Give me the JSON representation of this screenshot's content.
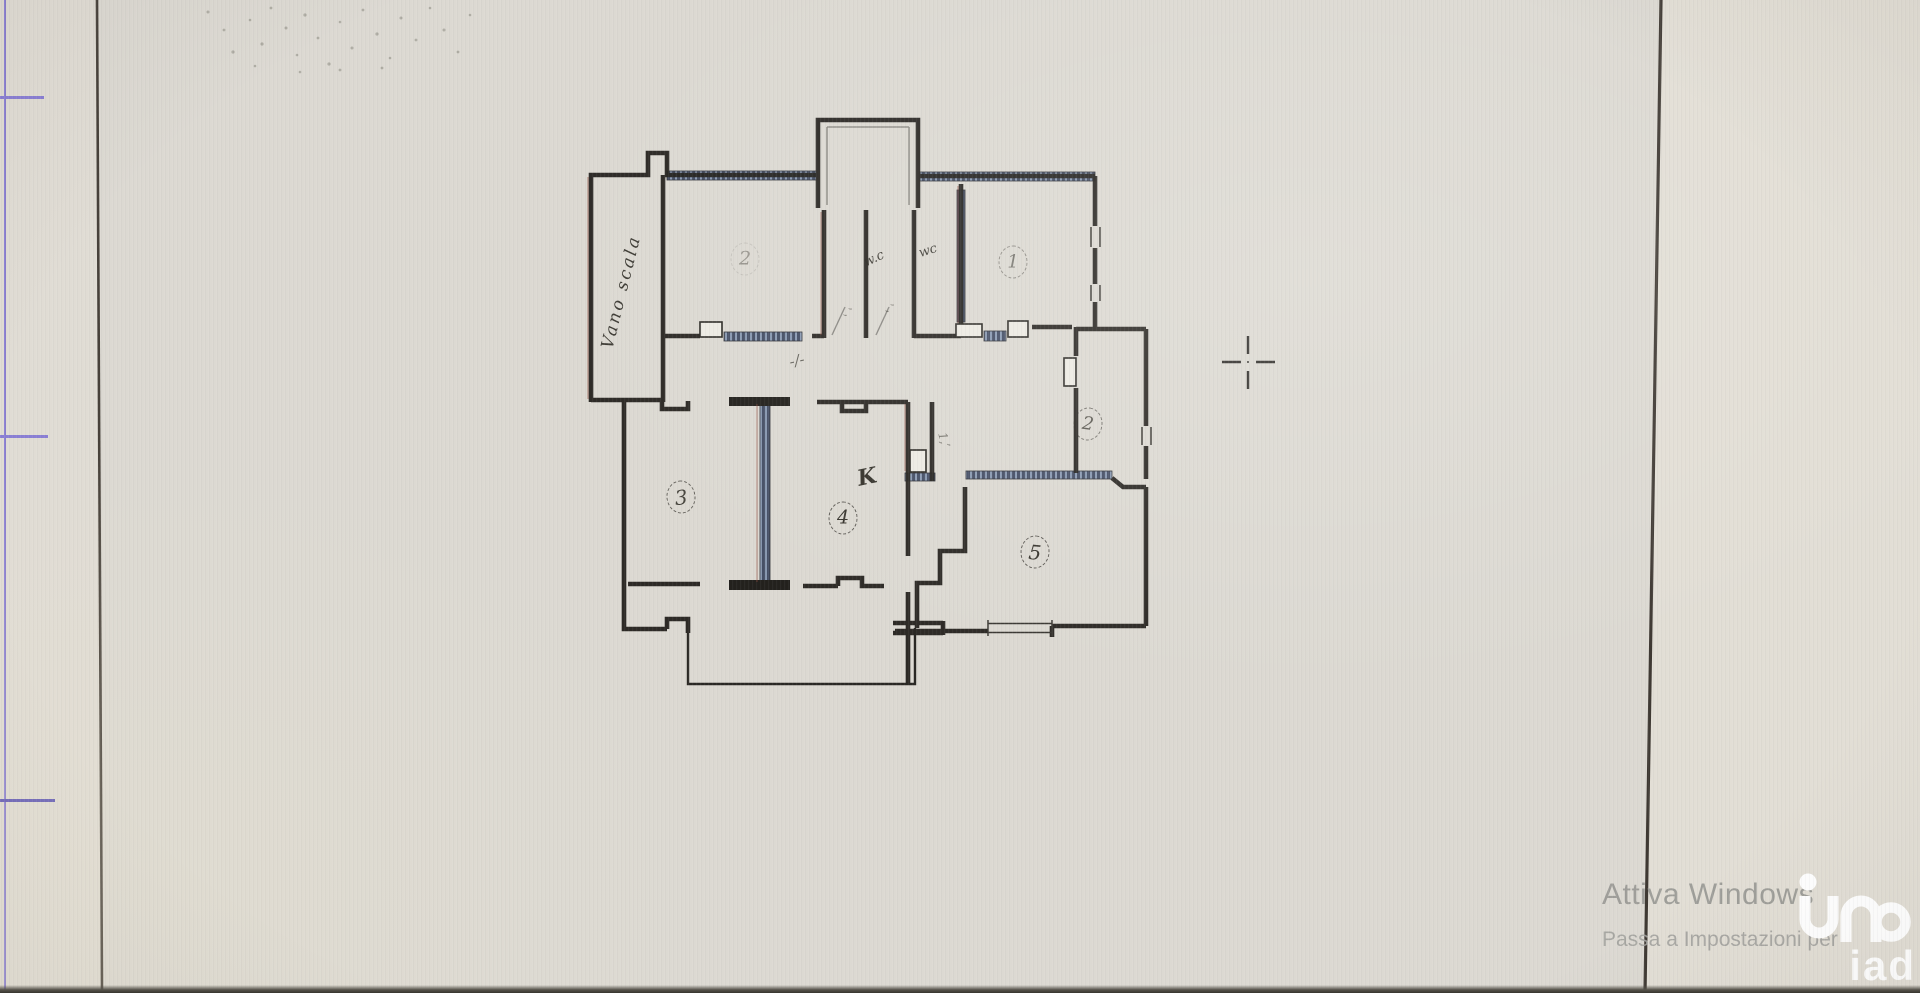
{
  "scene": {
    "description": "photo of a monitor showing a scanned cadastral floor plan sheet",
    "paper_color": "#dcd9d2",
    "wall_color": "#23211d",
    "frame_line_color": "#453e36",
    "margin_line_color": "#7a6fd0"
  },
  "floorplan": {
    "stairwell_label": "Vano scala",
    "rooms": {
      "r1": {
        "label": "1"
      },
      "r2_top": {
        "label": "2"
      },
      "r2_right": {
        "label": "2"
      },
      "r3": {
        "label": "3"
      },
      "r4": {
        "label": "4"
      },
      "r5": {
        "label": "5"
      },
      "kitchen": {
        "label": "K"
      },
      "wc1": {
        "label": "w.c"
      },
      "wc2": {
        "label": "wc"
      }
    },
    "marks": {
      "m1": "-/-",
      "m2": "’,",
      "m3": "1,’",
      "m4": "’,"
    }
  },
  "watermark": {
    "line1": "Attiva Windows",
    "line2": "Passa a Impostazioni per",
    "color": "#9a9a96"
  },
  "logo": {
    "text": "iad",
    "color": "#ffffff"
  }
}
